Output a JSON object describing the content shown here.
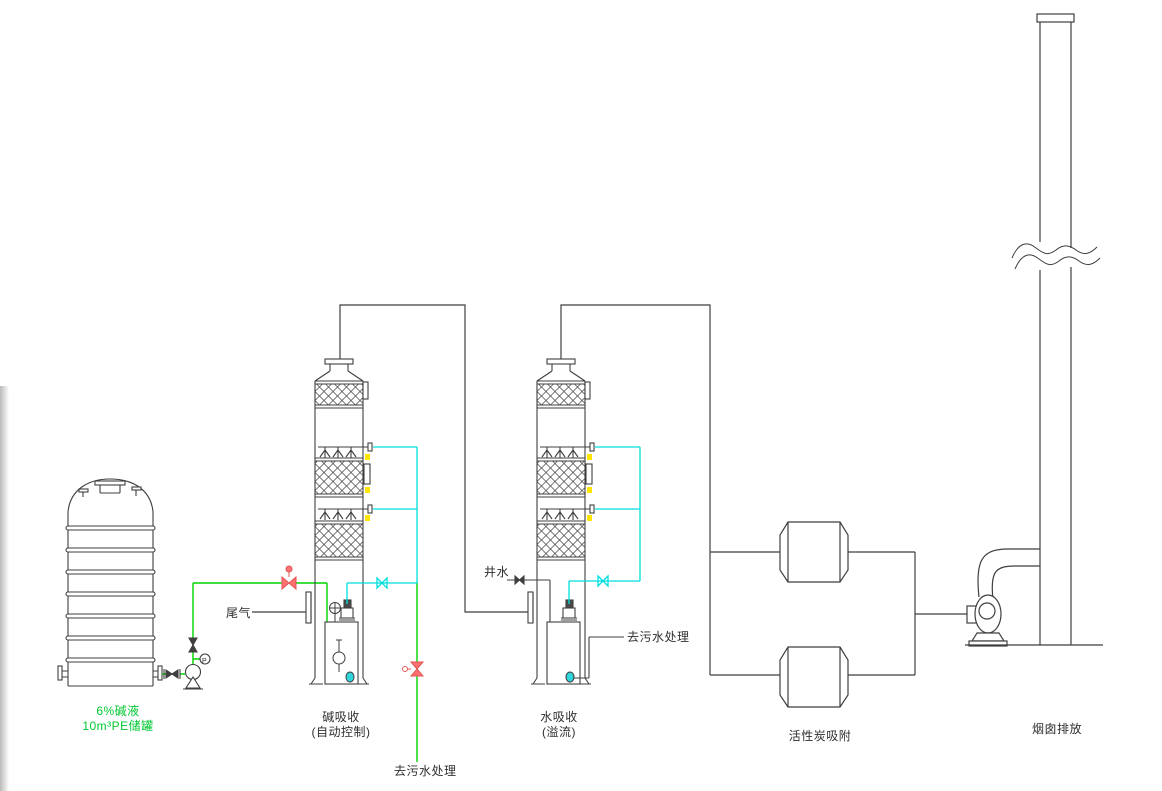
{
  "diagram": {
    "type": "process-flow-diagram",
    "labels": {
      "tank_spec_line1": "6%碱液",
      "tank_spec_line2": "10m³PE储罐",
      "tail_gas": "尾气",
      "tower1_name": "碱吸收",
      "tower1_mode": "(自动控制)",
      "well_water": "井水",
      "tower2_name": "水吸收",
      "tower2_mode": "(溢流)",
      "to_sewage_side": "去污水处理",
      "to_sewage_bottom": "去污水处理",
      "carbon_name": "活性炭吸附",
      "stack_name": "烟囱排放",
      "pressure_gauge_tag": "P"
    },
    "colors": {
      "line": "#3f3f3f",
      "alkali_pipe_green": "#00d400",
      "water_pipe_cyan": "#00dede",
      "valve_red": "#ff7070",
      "fitting_yellow": "#ffe600",
      "tank_label_green": "#00c832",
      "label_text": "#2e2e2e"
    }
  }
}
